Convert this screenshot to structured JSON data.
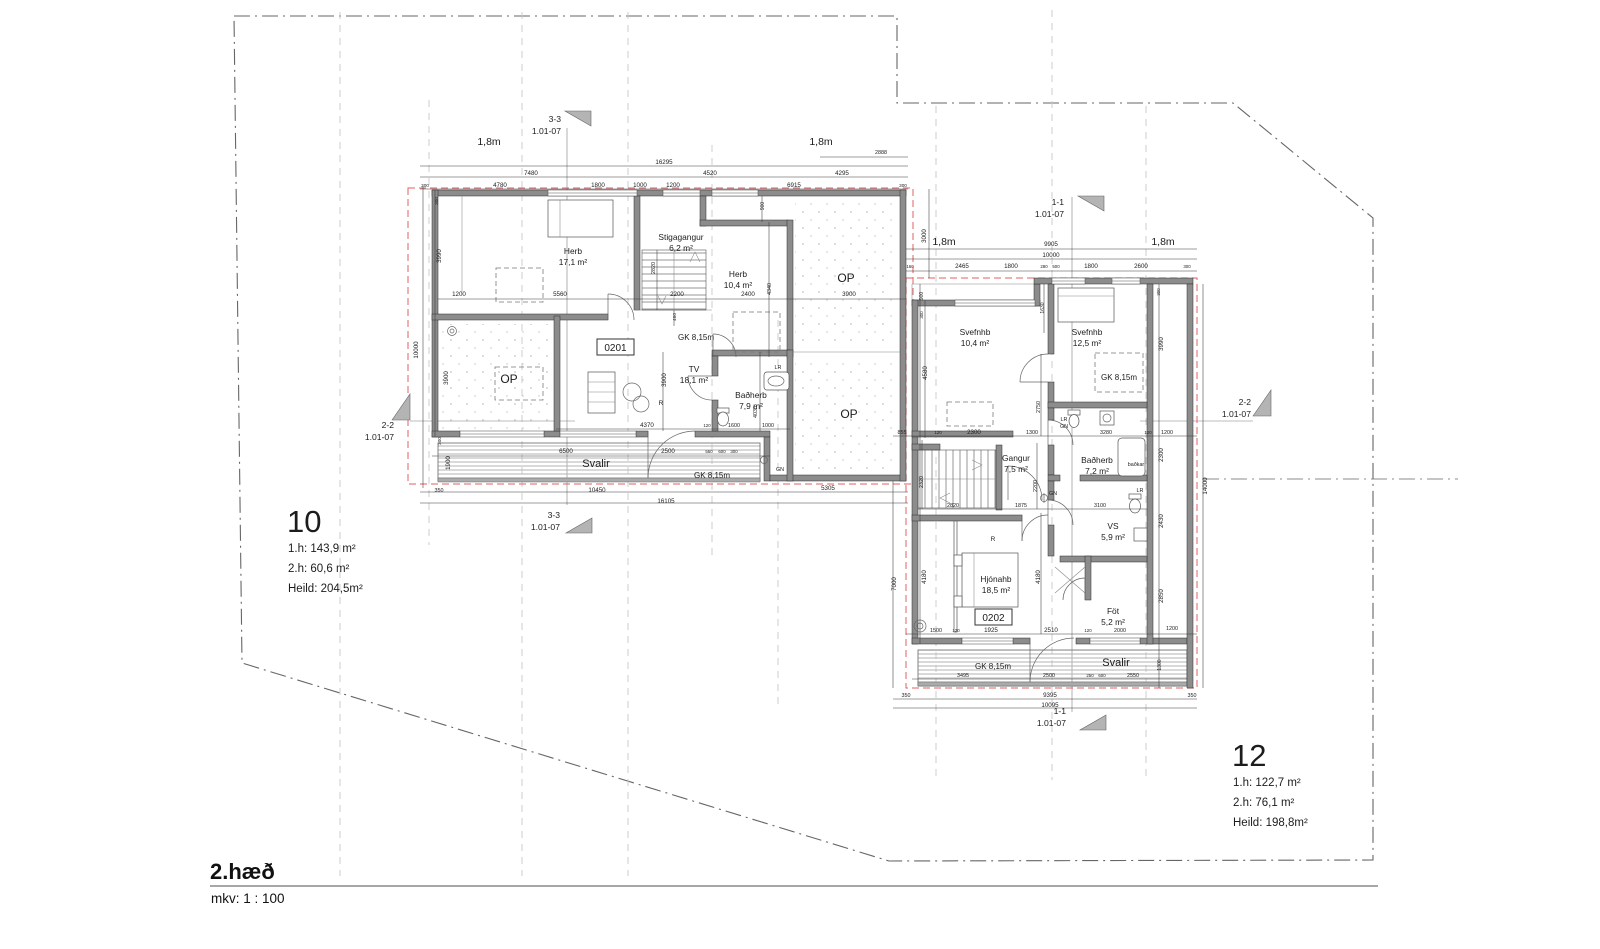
{
  "drawing": {
    "floor_label": "2.hæð",
    "scale_label": "mkv: 1 : 100"
  },
  "unit_cards": [
    {
      "number": "10",
      "area_lines": [
        "1.h: 143,9 m²",
        "2.h: 60,6 m²",
        "Heild: 204,5m²"
      ],
      "x": 287,
      "y": 532
    },
    {
      "number": "12",
      "area_lines": [
        "1.h: 122,7 m²",
        "2.h: 76,1 m²",
        "Heild: 198,8m²"
      ],
      "x": 1232,
      "y": 766
    }
  ],
  "apartment_boxes": [
    {
      "id": "0201",
      "bx": 597,
      "by": 339,
      "bw": 37,
      "bh": 16
    },
    {
      "id": "0202",
      "bx": 975,
      "by": 609,
      "bw": 37,
      "bh": 16
    }
  ],
  "section_markers": [
    {
      "l1": "3-3",
      "l2": "1.01-07",
      "x": 561,
      "y": 122,
      "flag": "565,111 591,111 591,126"
    },
    {
      "l1": "3-3",
      "l2": "1.01-07",
      "x": 560,
      "y": 518,
      "flag": "566,533 592,533 592,518"
    },
    {
      "l1": "1-1",
      "l2": "1.01-07",
      "x": 1064,
      "y": 205,
      "flag": "1078,196 1104,196 1104,211"
    },
    {
      "l1": "1-1",
      "l2": "1.01-07",
      "x": 1066,
      "y": 714,
      "flag": "1080,730 1106,730 1106,715"
    },
    {
      "l1": "2-2",
      "l2": "1.01-07",
      "x": 394,
      "y": 428,
      "flag": "392,420 410,394 410,420"
    },
    {
      "l1": "2-2",
      "l2": "1.01-07",
      "x": 1251,
      "y": 405,
      "flag": "1253,416 1271,390 1271,416"
    }
  ],
  "rooms": [
    {
      "n": "Herb",
      "a": "17,1 m²",
      "x": 573,
      "y": 254
    },
    {
      "n": "Stigagangur",
      "a": "6,2 m²",
      "x": 681,
      "y": 240
    },
    {
      "n": "Herb",
      "a": "10,4 m²",
      "x": 738,
      "y": 277
    },
    {
      "n": "TV",
      "a": "18,1 m²",
      "x": 694,
      "y": 372
    },
    {
      "n": "Baðherb",
      "a": "7,9 m²",
      "x": 751,
      "y": 398
    },
    {
      "n": "Svefnhb",
      "a": "10,4 m²",
      "x": 975,
      "y": 335
    },
    {
      "n": "Svefnhb",
      "a": "12,5 m²",
      "x": 1087,
      "y": 335
    },
    {
      "n": "Baðherb",
      "a": "7,2 m²",
      "x": 1097,
      "y": 463
    },
    {
      "n": "Gangur",
      "a": "7,5 m²",
      "x": 1016,
      "y": 461
    },
    {
      "n": "VS",
      "a": "5,9 m²",
      "x": 1113,
      "y": 529
    },
    {
      "n": "Hjónahb",
      "a": "18,5 m²",
      "x": 996,
      "y": 582
    },
    {
      "n": "Föt",
      "a": "5,2 m²",
      "x": 1113,
      "y": 614
    }
  ],
  "annotations": [
    {
      "t": "1,8m",
      "x": 489,
      "y": 145,
      "s": 10.5
    },
    {
      "t": "1,8m",
      "x": 821,
      "y": 145,
      "s": 10.5
    },
    {
      "t": "1,8m",
      "x": 944,
      "y": 245,
      "s": 10.5
    },
    {
      "t": "1,8m",
      "x": 1163,
      "y": 245,
      "s": 10.5
    },
    {
      "t": "OP",
      "x": 846,
      "y": 282,
      "s": 12
    },
    {
      "t": "OP",
      "x": 509,
      "y": 383,
      "s": 12
    },
    {
      "t": "OP",
      "x": 849,
      "y": 418,
      "s": 12
    },
    {
      "t": "GK 8,15m",
      "x": 696,
      "y": 340,
      "s": 8
    },
    {
      "t": "GK 8,15m",
      "x": 712,
      "y": 478,
      "s": 8
    },
    {
      "t": "GK 8,15m",
      "x": 1119,
      "y": 380,
      "s": 8
    },
    {
      "t": "GK 8,15m",
      "x": 993,
      "y": 669,
      "s": 8
    },
    {
      "t": "Svalir",
      "x": 596,
      "y": 467,
      "s": 11
    },
    {
      "t": "Svalir",
      "x": 1116,
      "y": 666,
      "s": 11
    },
    {
      "t": "LR",
      "x": 778,
      "y": 369,
      "s": 5.4
    },
    {
      "t": "GN",
      "x": 780,
      "y": 471,
      "s": 5.4
    },
    {
      "t": "LR",
      "x": 1064,
      "y": 421,
      "s": 5.4
    },
    {
      "t": "GN",
      "x": 1064,
      "y": 428,
      "s": 5.4
    },
    {
      "t": "GN",
      "x": 1053,
      "y": 495,
      "s": 5.4
    },
    {
      "t": "LR",
      "x": 1140,
      "y": 492,
      "s": 5.4
    },
    {
      "t": "baðkar",
      "x": 1136,
      "y": 466,
      "s": 5.4
    },
    {
      "t": "R",
      "x": 661,
      "y": 405,
      "s": 6.5
    },
    {
      "t": "R",
      "x": 993,
      "y": 541,
      "s": 6.5
    }
  ],
  "dims": [
    {
      "t": "16295",
      "x": 664,
      "y": 164
    },
    {
      "t": "7480",
      "x": 531,
      "y": 175
    },
    {
      "t": "4520",
      "x": 710,
      "y": 175
    },
    {
      "t": "4295",
      "x": 842,
      "y": 175
    },
    {
      "t": "300",
      "x": 425,
      "y": 187,
      "s": 4.6
    },
    {
      "t": "4780",
      "x": 500,
      "y": 187
    },
    {
      "t": "1800",
      "x": 598,
      "y": 187
    },
    {
      "t": "1000",
      "x": 640,
      "y": 187
    },
    {
      "t": "1200",
      "x": 673,
      "y": 187
    },
    {
      "t": "6915",
      "x": 794,
      "y": 187
    },
    {
      "t": "300",
      "x": 903,
      "y": 187,
      "s": 4.6
    },
    {
      "t": "2888",
      "x": 881,
      "y": 154,
      "s": 5.4
    },
    {
      "t": "300",
      "x": 438,
      "y": 201,
      "r": 1,
      "s": 4.6
    },
    {
      "t": "3990",
      "x": 441,
      "y": 256,
      "r": 1
    },
    {
      "t": "10000",
      "x": 418,
      "y": 350,
      "r": 1
    },
    {
      "t": "3900",
      "x": 448,
      "y": 378,
      "r": 1
    },
    {
      "t": "300",
      "x": 441,
      "y": 441,
      "r": 1,
      "s": 4.6
    },
    {
      "t": "1900",
      "x": 450,
      "y": 463,
      "r": 1
    },
    {
      "t": "350",
      "x": 439,
      "y": 492,
      "s": 5.4
    },
    {
      "t": "10450",
      "x": 597,
      "y": 492
    },
    {
      "t": "5305",
      "x": 828,
      "y": 490
    },
    {
      "t": "16105",
      "x": 666,
      "y": 503
    },
    {
      "t": "1200",
      "x": 459,
      "y": 296
    },
    {
      "t": "5560",
      "x": 560,
      "y": 296
    },
    {
      "t": "2200",
      "x": 677,
      "y": 296
    },
    {
      "t": "2400",
      "x": 748,
      "y": 296
    },
    {
      "t": "3900",
      "x": 849,
      "y": 296
    },
    {
      "t": "900",
      "x": 764,
      "y": 206,
      "r": 1,
      "s": 5
    },
    {
      "t": "2820",
      "x": 655,
      "y": 268,
      "r": 1,
      "s": 5.4
    },
    {
      "t": "4340",
      "x": 771,
      "y": 289,
      "r": 1,
      "s": 5.4
    },
    {
      "t": "460",
      "x": 676,
      "y": 317,
      "r": 1,
      "s": 4.8
    },
    {
      "t": "3900",
      "x": 666,
      "y": 380,
      "r": 1
    },
    {
      "t": "4030",
      "x": 757,
      "y": 412,
      "r": 1,
      "s": 5.4
    },
    {
      "t": "4370",
      "x": 647,
      "y": 427
    },
    {
      "t": "120",
      "x": 707,
      "y": 427,
      "s": 4.4
    },
    {
      "t": "1600",
      "x": 734,
      "y": 427,
      "s": 5.4
    },
    {
      "t": "1000",
      "x": 768,
      "y": 427,
      "s": 5.4
    },
    {
      "t": "6500",
      "x": 566,
      "y": 453
    },
    {
      "t": "2500",
      "x": 668,
      "y": 453
    },
    {
      "t": "550",
      "x": 709,
      "y": 453,
      "s": 4.4
    },
    {
      "t": "600",
      "x": 722,
      "y": 453,
      "s": 4.4
    },
    {
      "t": "300",
      "x": 734,
      "y": 453,
      "s": 4.4
    },
    {
      "t": "3000",
      "x": 926,
      "y": 236,
      "r": 1
    },
    {
      "t": "9905",
      "x": 1051,
      "y": 246
    },
    {
      "t": "10000",
      "x": 1051,
      "y": 257
    },
    {
      "t": "160",
      "x": 910,
      "y": 268,
      "s": 4.4
    },
    {
      "t": "2465",
      "x": 962,
      "y": 268
    },
    {
      "t": "1800",
      "x": 1011,
      "y": 268
    },
    {
      "t": "280",
      "x": 1044,
      "y": 268,
      "s": 4.4
    },
    {
      "t": "500",
      "x": 1056,
      "y": 268,
      "s": 4.4
    },
    {
      "t": "1800",
      "x": 1091,
      "y": 268
    },
    {
      "t": "2600",
      "x": 1141,
      "y": 268
    },
    {
      "t": "300",
      "x": 1187,
      "y": 268,
      "s": 4.4
    },
    {
      "t": "900",
      "x": 923,
      "y": 296,
      "r": 1,
      "s": 5
    },
    {
      "t": "300",
      "x": 923,
      "y": 315,
      "r": 1,
      "s": 4.4
    },
    {
      "t": "4580",
      "x": 927,
      "y": 373,
      "r": 1
    },
    {
      "t": "2320",
      "x": 923,
      "y": 482,
      "r": 1,
      "s": 5.4
    },
    {
      "t": "4180",
      "x": 926,
      "y": 577,
      "r": 1
    },
    {
      "t": "7000",
      "x": 896,
      "y": 584,
      "r": 1
    },
    {
      "t": "1630",
      "x": 1044,
      "y": 308,
      "r": 1,
      "s": 5
    },
    {
      "t": "2750",
      "x": 1040,
      "y": 407,
      "r": 1,
      "s": 5.4
    },
    {
      "t": "2200",
      "x": 1037,
      "y": 486,
      "r": 1,
      "s": 5.4
    },
    {
      "t": "4180",
      "x": 1040,
      "y": 577,
      "r": 1
    },
    {
      "t": "855",
      "x": 902,
      "y": 434,
      "s": 5.4
    },
    {
      "t": "120",
      "x": 938,
      "y": 434,
      "s": 4.4
    },
    {
      "t": "2300",
      "x": 974,
      "y": 434
    },
    {
      "t": "1300",
      "x": 1032,
      "y": 434,
      "s": 5.4
    },
    {
      "t": "3280",
      "x": 1106,
      "y": 434,
      "s": 5.4
    },
    {
      "t": "120",
      "x": 1148,
      "y": 434,
      "s": 4.4
    },
    {
      "t": "1200",
      "x": 1167,
      "y": 434,
      "s": 5.4
    },
    {
      "t": "2820",
      "x": 953,
      "y": 507,
      "s": 5.4
    },
    {
      "t": "1875",
      "x": 1021,
      "y": 507,
      "s": 5.4
    },
    {
      "t": "3100",
      "x": 1100,
      "y": 507,
      "s": 5.4
    },
    {
      "t": "300",
      "x": 1160,
      "y": 292,
      "r": 1,
      "s": 4.4
    },
    {
      "t": "3990",
      "x": 1163,
      "y": 344,
      "r": 1
    },
    {
      "t": "2300",
      "x": 1163,
      "y": 455,
      "r": 1
    },
    {
      "t": "2430",
      "x": 1163,
      "y": 521,
      "r": 1
    },
    {
      "t": "2850",
      "x": 1163,
      "y": 596,
      "r": 1
    },
    {
      "t": "1300",
      "x": 1161,
      "y": 665,
      "r": 1,
      "s": 5
    },
    {
      "t": "14000",
      "x": 1207,
      "y": 486,
      "r": 1
    },
    {
      "t": "1500",
      "x": 936,
      "y": 632,
      "s": 5.4
    },
    {
      "t": "120",
      "x": 956,
      "y": 632,
      "s": 4.4
    },
    {
      "t": "1925",
      "x": 991,
      "y": 632
    },
    {
      "t": "2510",
      "x": 1051,
      "y": 632
    },
    {
      "t": "120",
      "x": 1088,
      "y": 632,
      "s": 4.4
    },
    {
      "t": "2000",
      "x": 1120,
      "y": 632,
      "s": 5.4
    },
    {
      "t": "1200",
      "x": 1172,
      "y": 630,
      "s": 5.4
    },
    {
      "t": "3495",
      "x": 963,
      "y": 677,
      "s": 5.4
    },
    {
      "t": "2500",
      "x": 1049,
      "y": 677,
      "s": 5.4
    },
    {
      "t": "250",
      "x": 1090,
      "y": 677,
      "s": 4.4
    },
    {
      "t": "600",
      "x": 1102,
      "y": 677,
      "s": 4.4
    },
    {
      "t": "2550",
      "x": 1133,
      "y": 677,
      "s": 5.4
    },
    {
      "t": "350",
      "x": 906,
      "y": 697,
      "s": 5.4
    },
    {
      "t": "9395",
      "x": 1050,
      "y": 697
    },
    {
      "t": "350",
      "x": 1192,
      "y": 697,
      "s": 5.4
    },
    {
      "t": "10095",
      "x": 1050,
      "y": 707
    }
  ]
}
